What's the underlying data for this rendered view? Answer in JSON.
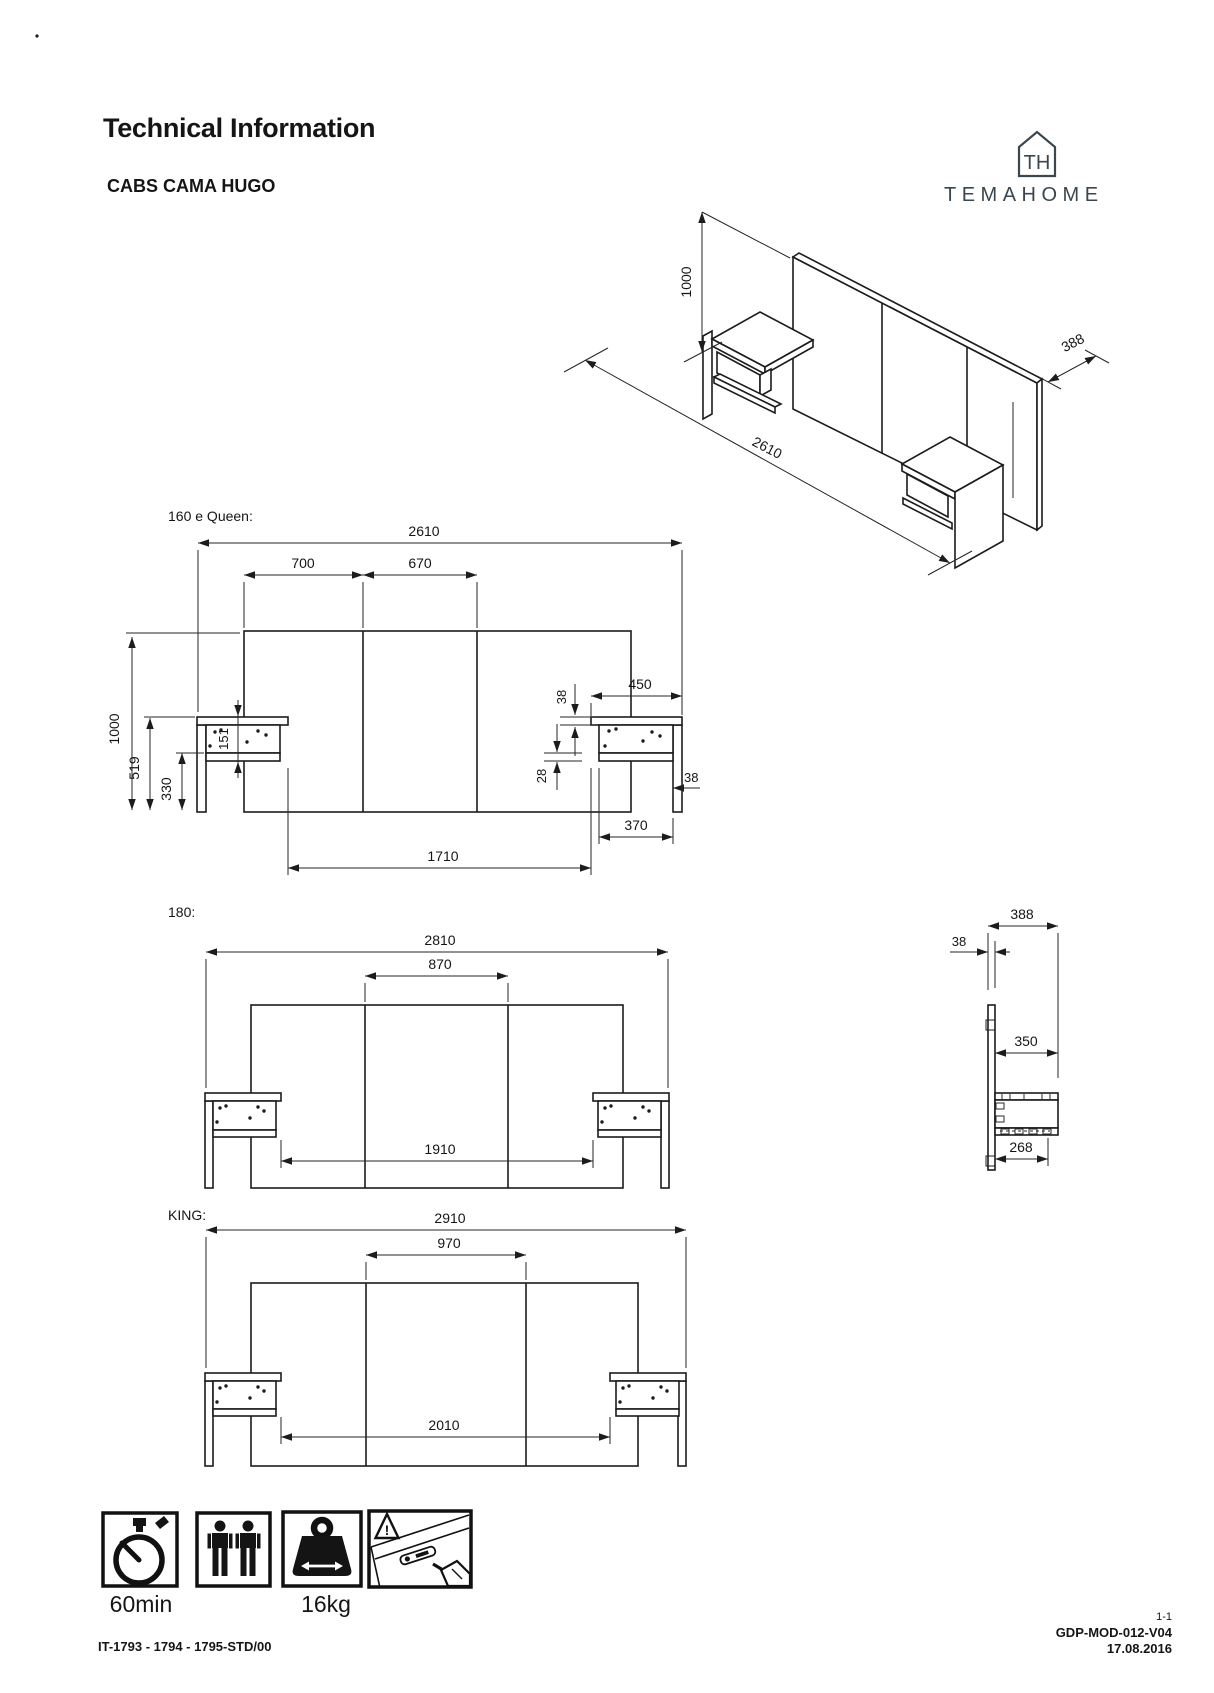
{
  "header": {
    "title": "Technical Information",
    "product": "CABS CAMA HUGO"
  },
  "logo": {
    "monogram": "TH",
    "name": "TEMAHOME"
  },
  "artifact": {
    "dot": "."
  },
  "iso": {
    "height": "1000",
    "length": "2610",
    "depth": "388"
  },
  "queen": {
    "title": "160 e Queen:",
    "total_width": "2610",
    "left_section": "700",
    "mid_section": "670",
    "nightstand_width": "450",
    "plate_thickness": "38",
    "shelf_gap": "28",
    "leg_thickness": "38",
    "shelf_width": "370",
    "inner_span": "1710",
    "height": "1000",
    "nightstand_height": "519",
    "shelf_clearance": "330",
    "box_height": "151"
  },
  "m180": {
    "title": "180:",
    "total_width": "2810",
    "mid_section": "870",
    "inner_span": "1910"
  },
  "side": {
    "total_depth": "388",
    "panel_thickness": "38",
    "nightstand_depth": "350",
    "shelf_depth": "268"
  },
  "king": {
    "title": "KING:",
    "total_width": "2910",
    "mid_section": "970",
    "inner_span": "2010"
  },
  "icons": {
    "assembly_time": "60min",
    "max_weight": "16kg",
    "max_label": "max."
  },
  "footer": {
    "reference": "IT-1793 - 1794 - 1795-STD/00",
    "sheet": "1-1",
    "doc_code": "GDP-MOD-012-V04",
    "date": "17.08.2016"
  }
}
